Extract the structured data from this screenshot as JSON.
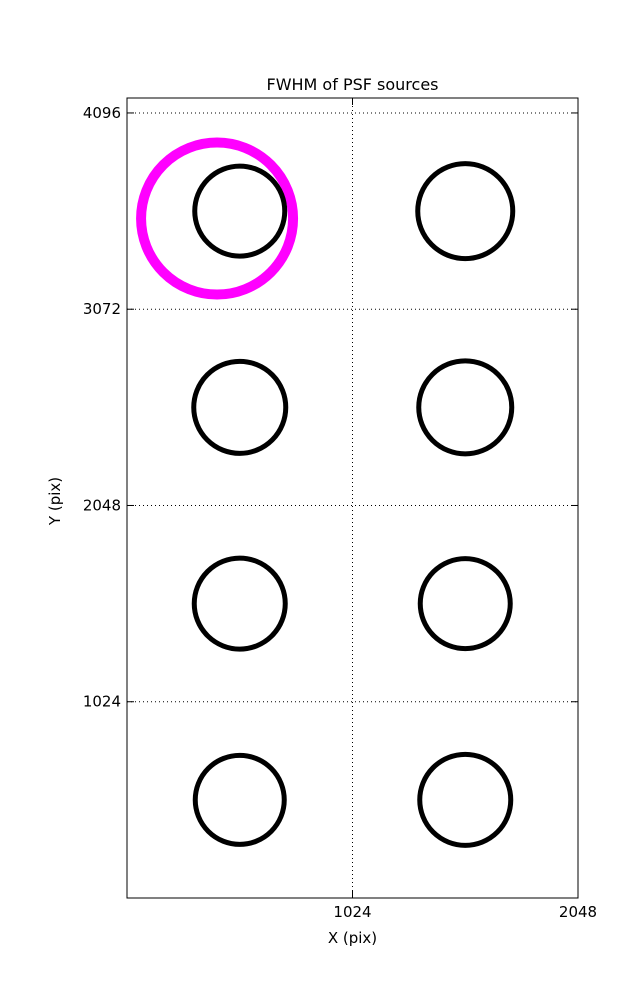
{
  "figure": {
    "background": "#ffffff"
  },
  "chart_data": {
    "type": "scatter",
    "title": "FWHM of PSF sources",
    "xlabel": "X (pix)",
    "ylabel": "Y (pix)",
    "xlim": [
      0,
      2048
    ],
    "ylim": [
      0,
      4174
    ],
    "xticks": [
      1024,
      2048
    ],
    "yticks": [
      1024,
      2048,
      3072,
      4096
    ],
    "grid": "dotted",
    "legend": "none",
    "axis_color": "#000000",
    "grid_color": "#000000",
    "marker_color": "#000000",
    "marker_stroke_px": 5,
    "sources": [
      {
        "x": 512,
        "y": 3584,
        "radius_px": 45.0
      },
      {
        "x": 1536,
        "y": 3584,
        "radius_px": 47.5
      },
      {
        "x": 512,
        "y": 2560,
        "radius_px": 46.0
      },
      {
        "x": 1536,
        "y": 2560,
        "radius_px": 46.5
      },
      {
        "x": 512,
        "y": 1536,
        "radius_px": 45.5
      },
      {
        "x": 1536,
        "y": 1536,
        "radius_px": 45.0
      },
      {
        "x": 512,
        "y": 512,
        "radius_px": 44.5
      },
      {
        "x": 1536,
        "y": 512,
        "radius_px": 45.5
      }
    ],
    "highlight": {
      "x": 409,
      "y": 3545,
      "radius_px": 76,
      "color": "#ff00ff",
      "stroke_px": 10
    }
  }
}
